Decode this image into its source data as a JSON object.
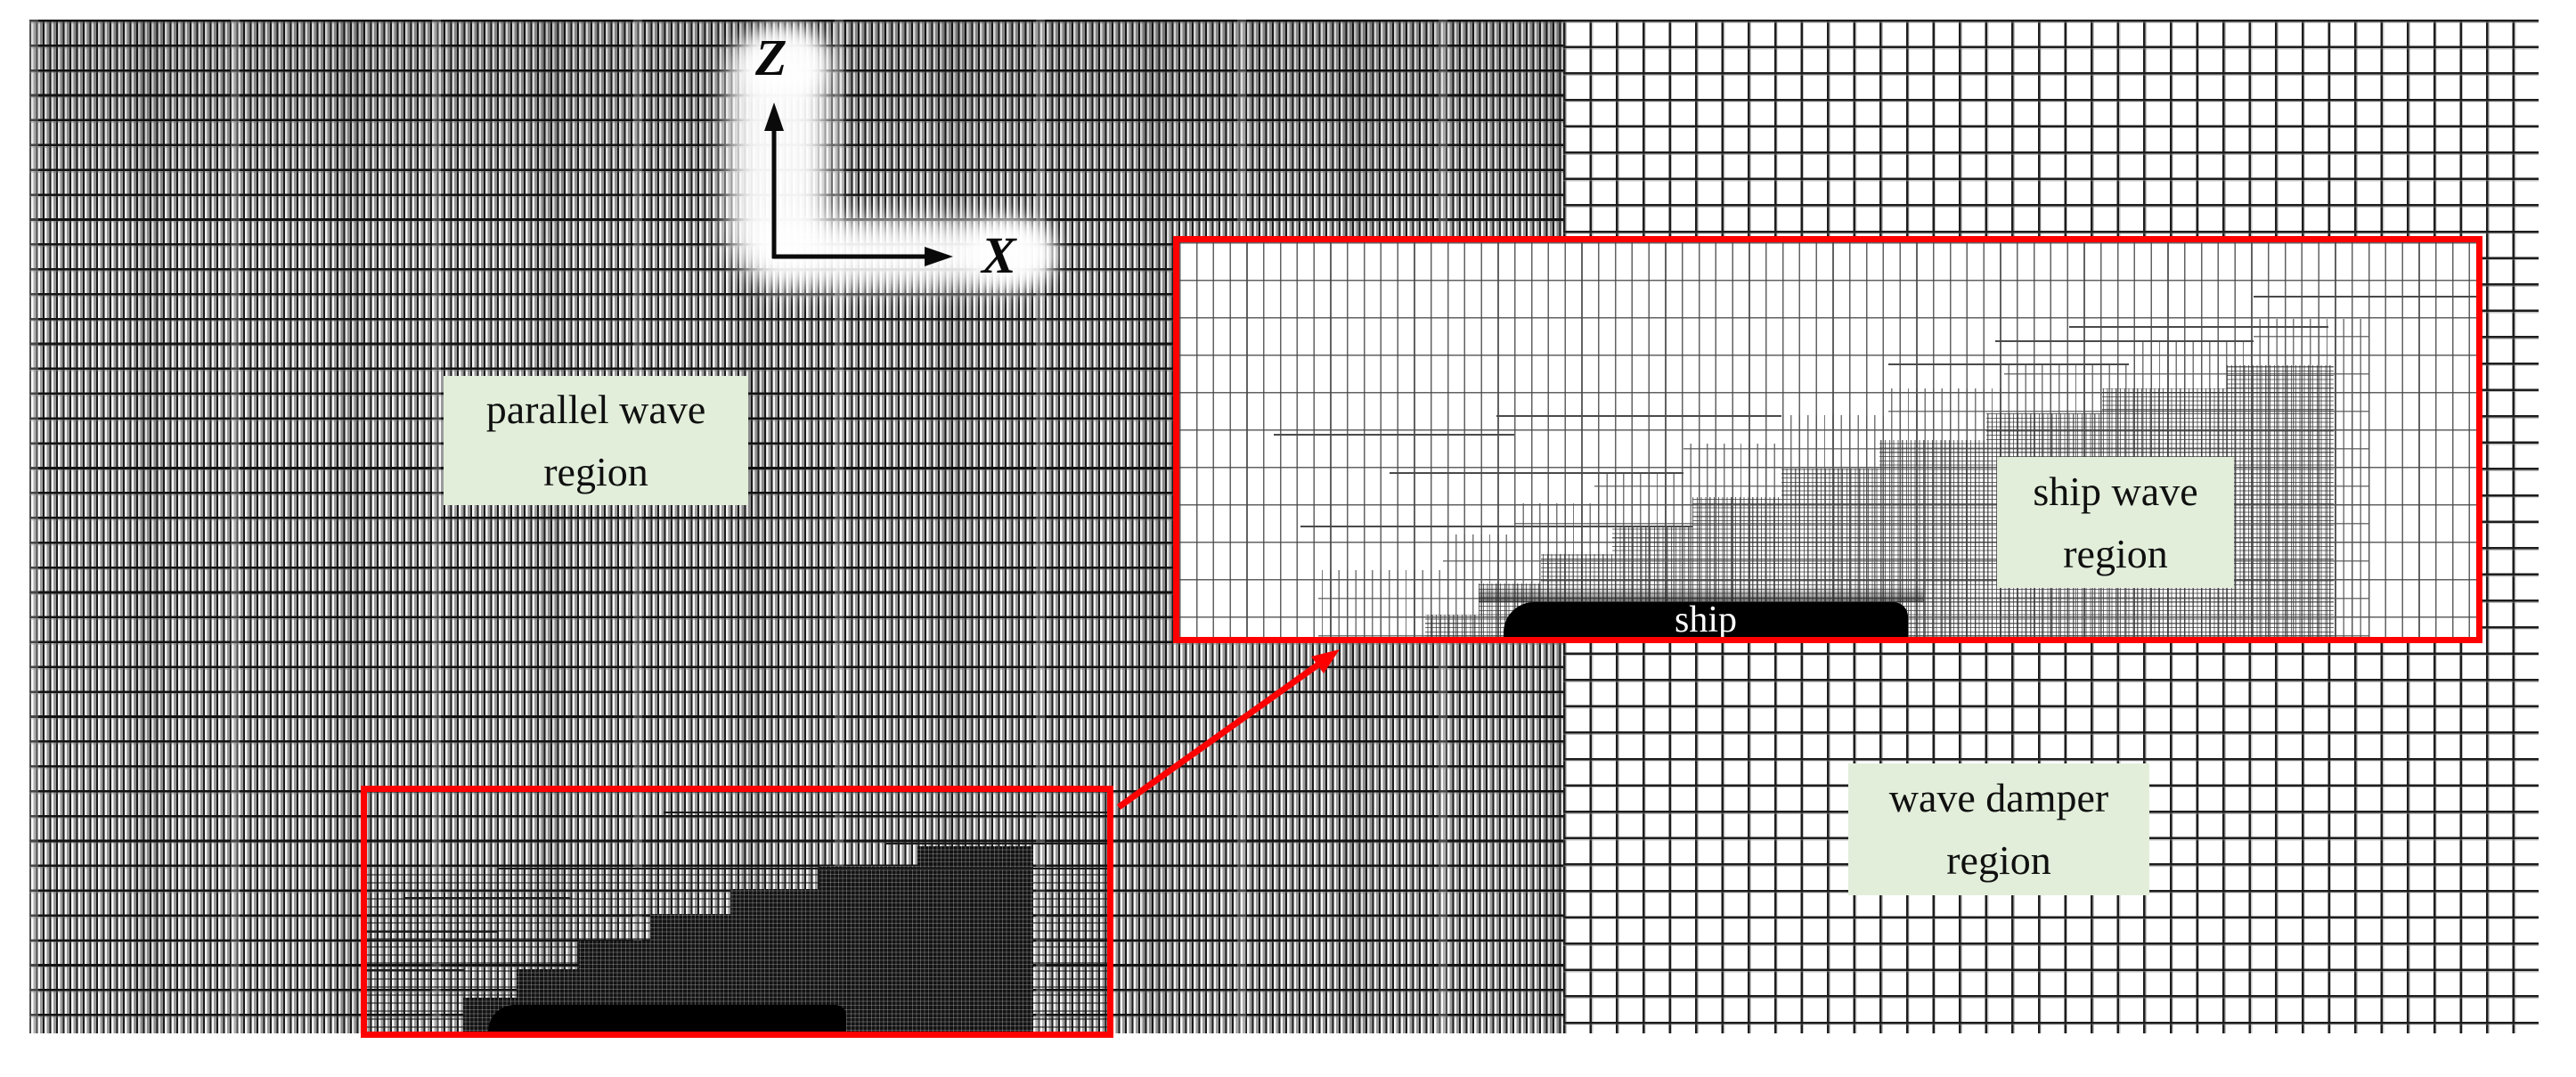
{
  "figure": {
    "axis": {
      "vertical_label": "Z",
      "horizontal_label": "X"
    },
    "regions": {
      "parallel_wave": {
        "line1": "parallel wave",
        "line2": "region"
      },
      "ship_wave": {
        "line1": "ship wave",
        "line2": "region"
      },
      "wave_damper": {
        "line1": "wave damper",
        "line2": "region"
      },
      "ship_label": "ship"
    },
    "colors": {
      "label_background": "#e2eeda",
      "highlight_red": "#fe0000",
      "mesh_line": "#1b1b1b",
      "ship_fill": "#000000",
      "ship_text": "#ffffff",
      "label_text": "#101010"
    }
  }
}
